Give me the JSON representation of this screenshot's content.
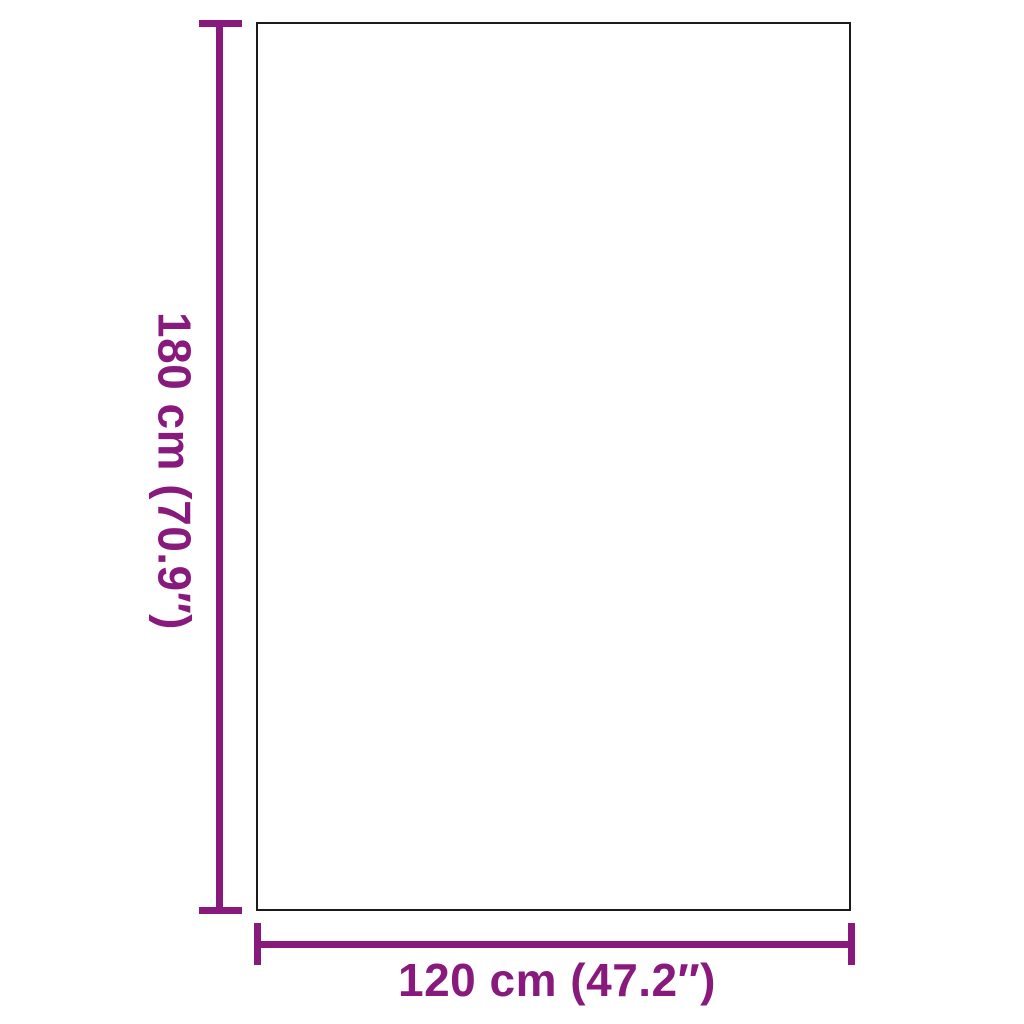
{
  "colors": {
    "accent": "#881A7D",
    "outline": "#1B1B1B",
    "background": "#FFFFFF"
  },
  "diagram": {
    "type": "product-dimension-diagram",
    "object_shape": "rectangle",
    "height_label": "180 cm (70.9″)",
    "width_label": "120 cm (47.2″)"
  }
}
